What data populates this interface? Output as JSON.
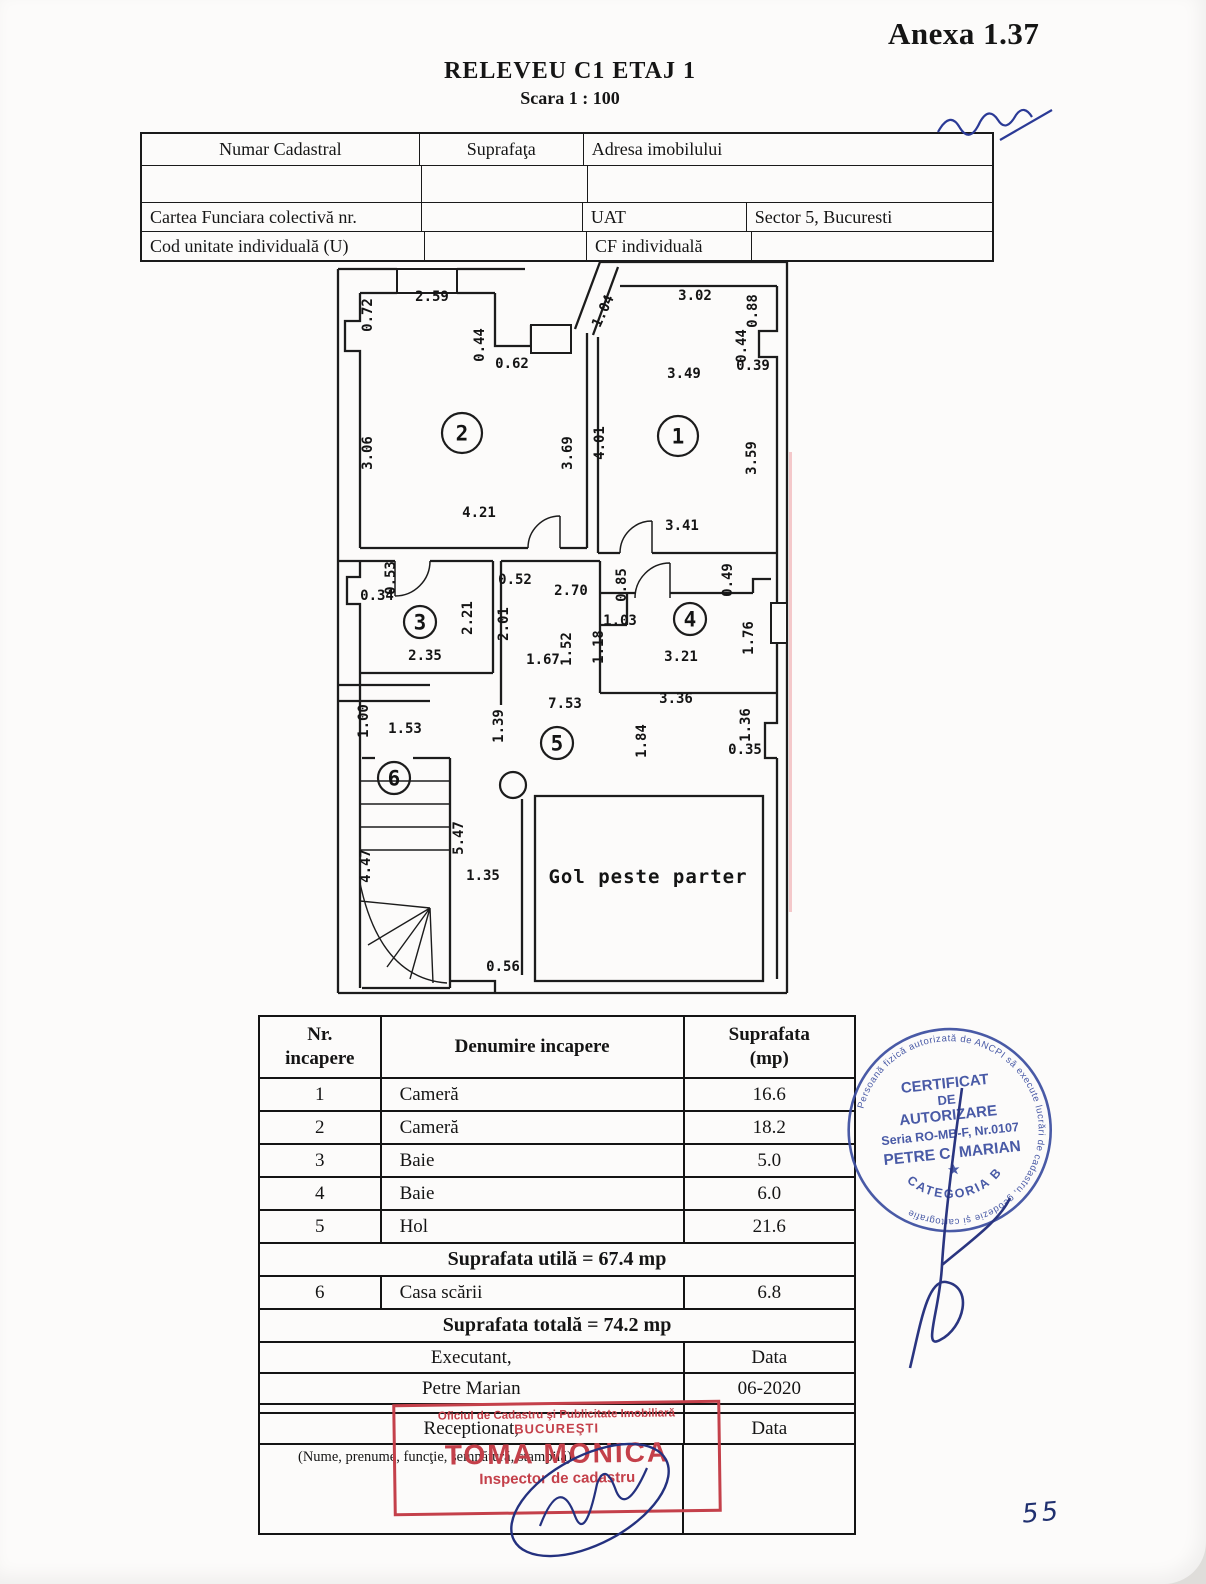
{
  "page": {
    "annex": "Anexa 1.37",
    "title": "RELEVEU C1 ETAJ 1",
    "scale": "Scara 1 : 100",
    "page_number": "55"
  },
  "info_table": {
    "r1c1": "Numar Cadastral",
    "r1c2": "Suprafaţa",
    "r1c3": "Adresa imobilului",
    "r3c1": "Cartea Funciara colectivă nr.",
    "r3c3": "UAT",
    "r3c4": "Sector 5, Bucuresti",
    "r4c1": "Cod unitate individuală (U)",
    "r4c3": "CF individuală"
  },
  "plan": {
    "gol_label": "Gol peste parter",
    "rooms": [
      {
        "n": "1",
        "x": 343,
        "y": 183,
        "big": true
      },
      {
        "n": "2",
        "x": 127,
        "y": 180,
        "big": true
      },
      {
        "n": "3",
        "x": 85,
        "y": 369
      },
      {
        "n": "4",
        "x": 355,
        "y": 366
      },
      {
        "n": "5",
        "x": 222,
        "y": 490
      },
      {
        "n": "6",
        "x": 59,
        "y": 525
      }
    ],
    "dims": [
      {
        "t": "2.59",
        "x": 97,
        "y": 48,
        "r": 0
      },
      {
        "t": "0.72",
        "x": 37,
        "y": 62,
        "r": -90
      },
      {
        "t": "0.44",
        "x": 149,
        "y": 92,
        "r": -90
      },
      {
        "t": "0.62",
        "x": 177,
        "y": 115,
        "r": 0
      },
      {
        "t": "1.04",
        "x": 272,
        "y": 60,
        "r": -65
      },
      {
        "t": "3.02",
        "x": 360,
        "y": 47,
        "r": 0
      },
      {
        "t": "0.88",
        "x": 422,
        "y": 58,
        "r": -90
      },
      {
        "t": "0.44",
        "x": 411,
        "y": 93,
        "r": -90
      },
      {
        "t": "0.39",
        "x": 418,
        "y": 117,
        "r": 0
      },
      {
        "t": "3.49",
        "x": 349,
        "y": 125,
        "r": 0
      },
      {
        "t": "3.06",
        "x": 37,
        "y": 200,
        "r": -90
      },
      {
        "t": "3.69",
        "x": 237,
        "y": 200,
        "r": -90
      },
      {
        "t": "4.01",
        "x": 269,
        "y": 190,
        "r": -90
      },
      {
        "t": "3.59",
        "x": 421,
        "y": 205,
        "r": -90
      },
      {
        "t": "4.21",
        "x": 144,
        "y": 264,
        "r": 0
      },
      {
        "t": "3.41",
        "x": 347,
        "y": 277,
        "r": 0
      },
      {
        "t": "0.53",
        "x": 60,
        "y": 325,
        "r": -90
      },
      {
        "t": "0.34",
        "x": 42,
        "y": 347,
        "r": 0
      },
      {
        "t": "2.21",
        "x": 137,
        "y": 365,
        "r": -90
      },
      {
        "t": "0.52",
        "x": 180,
        "y": 331,
        "r": 0
      },
      {
        "t": "2.70",
        "x": 236,
        "y": 342,
        "r": 0
      },
      {
        "t": "0.85",
        "x": 291,
        "y": 332,
        "r": -90
      },
      {
        "t": "0.49",
        "x": 397,
        "y": 327,
        "r": -90
      },
      {
        "t": "2.01",
        "x": 173,
        "y": 371,
        "r": -90
      },
      {
        "t": "1.03",
        "x": 285,
        "y": 372,
        "r": 0
      },
      {
        "t": "1.18",
        "x": 268,
        "y": 394,
        "r": -90
      },
      {
        "t": "1.52",
        "x": 236,
        "y": 396,
        "r": -90
      },
      {
        "t": "1.76",
        "x": 418,
        "y": 385,
        "r": -90
      },
      {
        "t": "2.35",
        "x": 90,
        "y": 407,
        "r": 0
      },
      {
        "t": "1.67",
        "x": 208,
        "y": 411,
        "r": 0
      },
      {
        "t": "3.21",
        "x": 346,
        "y": 408,
        "r": 0
      },
      {
        "t": "3.36",
        "x": 341,
        "y": 450,
        "r": 0
      },
      {
        "t": "7.53",
        "x": 230,
        "y": 455,
        "r": 0
      },
      {
        "t": "1.39",
        "x": 168,
        "y": 473,
        "r": -90
      },
      {
        "t": "1.84",
        "x": 311,
        "y": 488,
        "r": -90
      },
      {
        "t": "1.36",
        "x": 415,
        "y": 472,
        "r": -90
      },
      {
        "t": "0.35",
        "x": 410,
        "y": 501,
        "r": 0
      },
      {
        "t": "1.00",
        "x": 33,
        "y": 468,
        "r": -90
      },
      {
        "t": "1.53",
        "x": 70,
        "y": 480,
        "r": 0
      },
      {
        "t": "5.47",
        "x": 128,
        "y": 585,
        "r": -90
      },
      {
        "t": "4.47",
        "x": 35,
        "y": 613,
        "r": -90
      },
      {
        "t": "1.35",
        "x": 148,
        "y": 627,
        "r": 0
      },
      {
        "t": "0.56",
        "x": 168,
        "y": 718,
        "r": 0
      }
    ]
  },
  "rooms_table": {
    "header": {
      "col1a": "Nr.",
      "col1b": "incapere",
      "col2": "Denumire incapere",
      "col3a": "Suprafata",
      "col3b": "(mp)"
    },
    "rows": [
      {
        "type": "data",
        "nr": "1",
        "name": "Cameră",
        "area": "16.6"
      },
      {
        "type": "data",
        "nr": "2",
        "name": "Cameră",
        "area": "18.2"
      },
      {
        "type": "data",
        "nr": "3",
        "name": "Baie",
        "area": "5.0"
      },
      {
        "type": "data",
        "nr": "4",
        "name": "Baie",
        "area": "6.0"
      },
      {
        "type": "data",
        "nr": "5",
        "name": "Hol",
        "area": "21.6"
      },
      {
        "type": "merged",
        "text": "Suprafata utilă = 67.4 mp"
      },
      {
        "type": "data",
        "nr": "6",
        "name": "Casa scării",
        "area": "6.8"
      },
      {
        "type": "merged",
        "text": "Suprafata totală = 74.2 mp"
      },
      {
        "type": "split",
        "left": "Executant,",
        "right": "Data"
      },
      {
        "type": "split",
        "left": "Petre Marian",
        "right": "06-2020"
      },
      {
        "type": "gap",
        "left": "",
        "right": ""
      },
      {
        "type": "split",
        "left": "Receptionat,",
        "right": "Data"
      },
      {
        "type": "note",
        "text": "(Nume, prenume, funcţie, semnătură, stampilă)"
      }
    ]
  },
  "stamps": {
    "rect_stamp": {
      "line1": "Oficiul de Cadastru şi Publicitate Imobiliară",
      "line2": "BUCUREŞTI",
      "line3": "TOMA MONICA",
      "line4": "Inspector de cadastru",
      "color": "#c4404a"
    },
    "round_stamp": {
      "ring": "Persoană fizică autorizată de ANCPI să execute lucrări de cadastru, geodezie şi cartografie",
      "l1": "CERTIFICAT",
      "l2": "DE",
      "l3": "AUTORIZARE",
      "l4": "Seria RO-MB-F, Nr.0107",
      "l5": "PETRE C. MARIAN",
      "star": "★",
      "l6": "CATEGORIA B",
      "color": "#3c4ea0"
    }
  }
}
